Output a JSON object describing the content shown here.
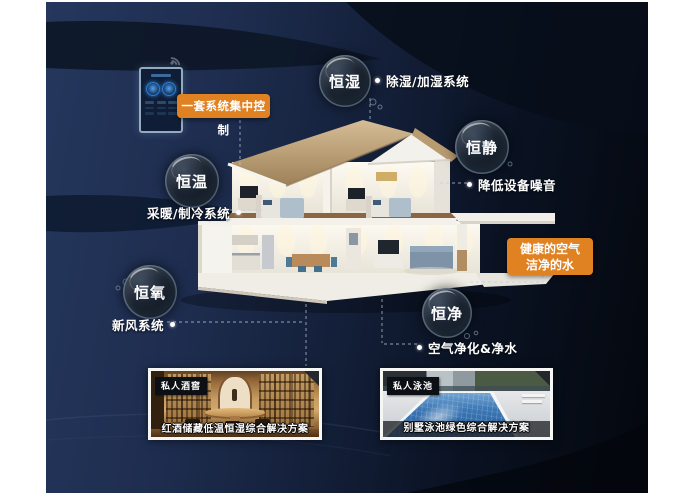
{
  "scene": {
    "control_panel_badge": "一套系统集中控制",
    "highlight_badge": {
      "line1": "健康的空气",
      "line2": "洁净的水"
    },
    "features": [
      {
        "bubble": "恒湿",
        "label": "除湿/加湿系统"
      },
      {
        "bubble": "恒静",
        "label": "降低设备噪音"
      },
      {
        "bubble": "恒温",
        "label": "采暖/制冷系统"
      },
      {
        "bubble": "恒氧",
        "label": "新风系统"
      },
      {
        "bubble": "恒净",
        "label": "空气净化&净水"
      }
    ],
    "photos": [
      {
        "tag": "私人酒窖",
        "caption": "红酒储藏低温恒湿综合解决方案"
      },
      {
        "tag": "私人泳池",
        "caption": "别墅泳池绿色综合解决方案"
      }
    ],
    "icons": {
      "wifi": "wifi-icon",
      "control_knobs": "dial-knob-icon"
    },
    "colors": {
      "accent_orange": "#e08122",
      "background_navy": "#1e2d4f",
      "background_dark": "#04070d",
      "bubble_dark": "#0b1018",
      "text_white": "#ffffff"
    }
  }
}
